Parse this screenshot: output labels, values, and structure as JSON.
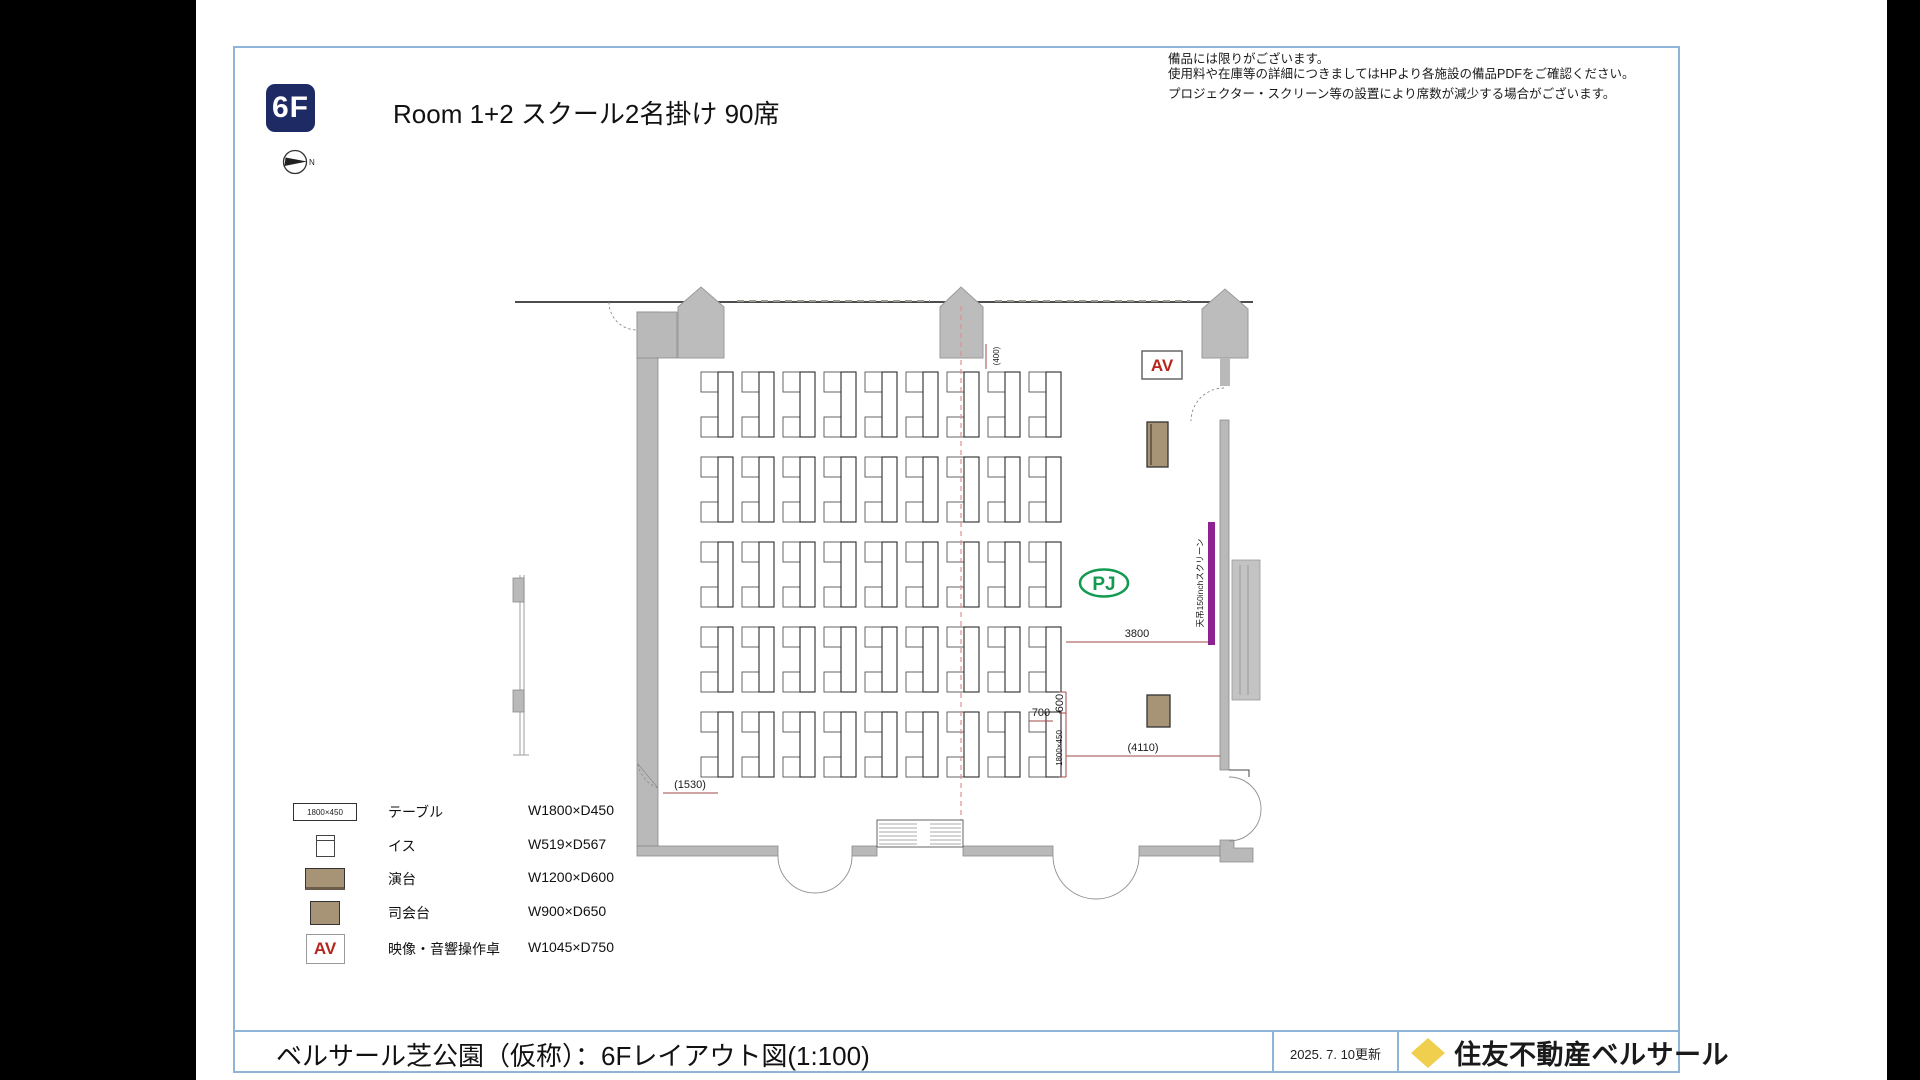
{
  "page": {
    "floor_badge": "6F",
    "title": "Room 1+2 スクール2名掛け 90席",
    "north_label": "N"
  },
  "notes": {
    "line1": "備品には限りがございます。",
    "line2": "使用料や在庫等の詳細につきましてはHPより各施設の備品PDFをご確認ください。",
    "line3": "プロジェクター・スクリーン等の設置により席数が減少する場合がございます。"
  },
  "plan": {
    "av_label": "AV",
    "pj_label": "PJ",
    "screen_label": "天吊150inchスクリーン",
    "seat_count": 90,
    "dimensions": {
      "d3800": "3800",
      "d700": "700",
      "d600": "600",
      "table_size": "1800×450",
      "d4110": "(4110)",
      "d1530": "(1530)",
      "d870": "(870)",
      "d400": "(400)"
    },
    "grid": {
      "rows": 5,
      "cols": 9,
      "row_y": [
        372,
        457,
        542,
        627,
        712
      ],
      "first_table_x": 718,
      "pitch": 41,
      "table_w": 15,
      "table_h": 65,
      "chair_w": 17,
      "chair_h": 20,
      "bottom_chair_offset": 45
    }
  },
  "legend": {
    "rows": [
      {
        "icon": "table",
        "icon_text": "1800×450",
        "label": "テーブル",
        "size": "W1800×D450"
      },
      {
        "icon": "chair",
        "icon_text": "",
        "label": "イス",
        "size": "W519×D567"
      },
      {
        "icon": "lectern",
        "icon_text": "",
        "label": "演台",
        "size": "W1200×D600"
      },
      {
        "icon": "mc-desk",
        "icon_text": "",
        "label": "司会台",
        "size": "W900×D650"
      },
      {
        "icon": "av",
        "icon_text": "AV",
        "label": "映像・音響操作卓",
        "size": "W1045×D750"
      }
    ]
  },
  "footer": {
    "title": "ベルサール芝公園（仮称）：6Fレイアウト図(1:100)",
    "updated": "2025. 7. 10更新",
    "brand": "住友不動産ベルサール"
  },
  "colors": {
    "accent_navy": "#1e2a63",
    "screen_purple": "#8e2290",
    "pj_green": "#119a50",
    "av_red": "#b5271d",
    "wood_brown": "#a79476",
    "border_blue": "#8fb4d8",
    "brand_yellow": "#f0cf4f",
    "dim_red": "#a04a44"
  }
}
